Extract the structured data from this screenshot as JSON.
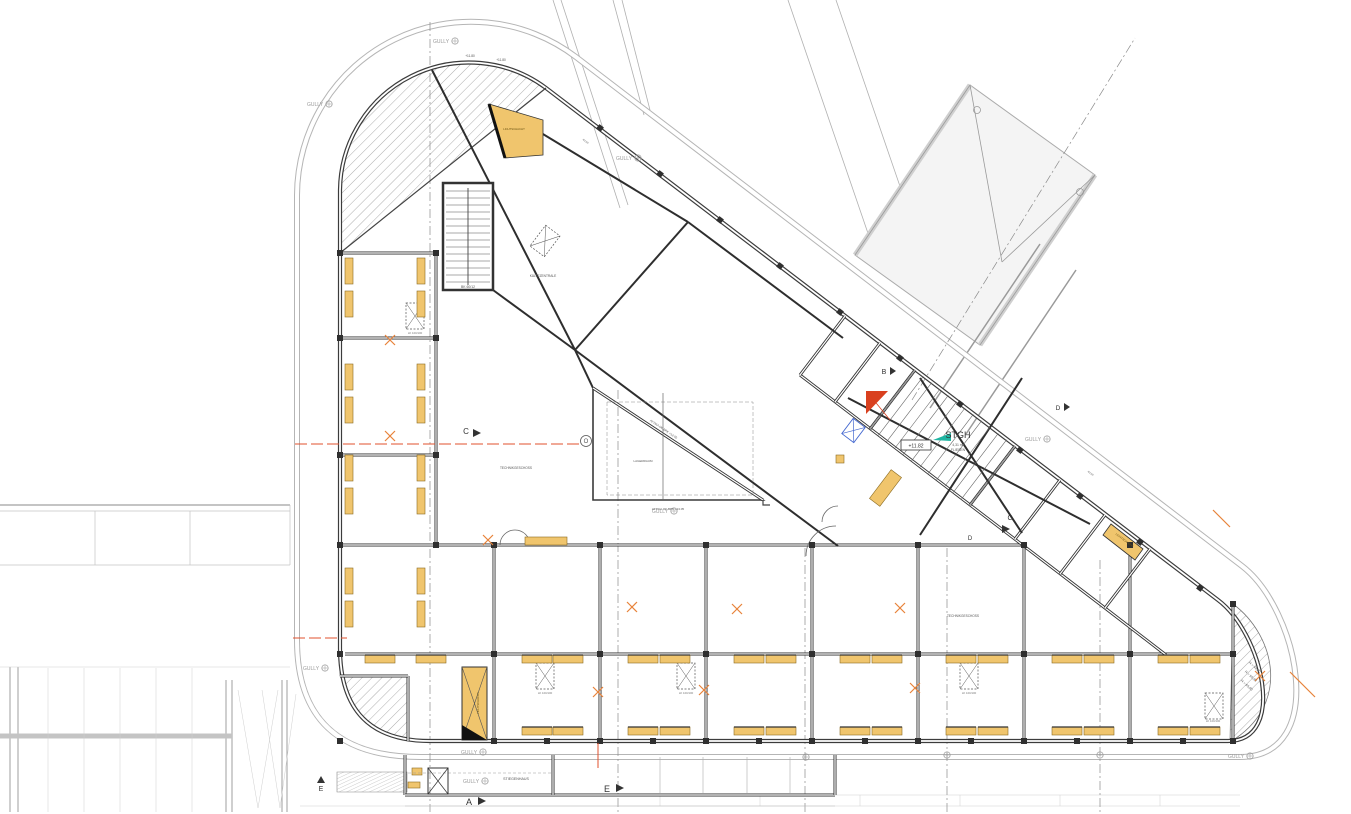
{
  "colors": {
    "paper": "#ffffff",
    "wall": "#3c3c3c",
    "dark": "#2e2e2e",
    "mid": "#8a8a8a",
    "light": "#c4c4c4",
    "ring": "#b5b5b5",
    "yellow": "#f0c56d",
    "yellow_stroke": "#8a6a20",
    "orange": "#e8833a",
    "red": "#d9401f",
    "redline": "#e0512e",
    "teal": "#1fb5a2",
    "blue": "#4468d0",
    "text": "#555555",
    "gully": "#9a9a9a"
  },
  "plan": {
    "paths": {
      "outer": "M 420,757 Q 297,757 297,640 L 297,195 A 174,174 0 0 1 576,57 L 1242,566 C 1298,609 1330,757 1240,757 Z",
      "facade": "M 430,741 Q 340,741 340,648 L 340,190 A 129,129 0 0 1 546,88 L 1218,600 C 1262,633 1288,741 1228,741 Z",
      "hatch_tl": "M 340,253 L 340,190 A 129,129 0 0 1 546,88 Z",
      "hatch_bl": "M 340,676 L 408,676 L 408,741 L 428,741 Q 342,740 340,650 Z",
      "hatch_br": "M 1233,604 C 1275,635 1292,705 1230,742 Z",
      "hatch_stairs": "M 337,772 L 407,772 L 407,792 L 337,792 Z"
    },
    "walls": [
      [
        340,
        545,
        1022,
        545
      ],
      [
        345,
        654,
        1233,
        654
      ],
      [
        494,
        545,
        494,
        741
      ],
      [
        600,
        545,
        600,
        741
      ],
      [
        706,
        545,
        706,
        741
      ],
      [
        812,
        545,
        812,
        741
      ],
      [
        918,
        545,
        918,
        741
      ],
      [
        1024,
        545,
        1024,
        741
      ],
      [
        1130,
        545,
        1130,
        741
      ],
      [
        1233,
        604,
        1233,
        741
      ],
      [
        436,
        253,
        436,
        545
      ],
      [
        340,
        253,
        436,
        253
      ],
      [
        340,
        338,
        436,
        338
      ],
      [
        340,
        455,
        436,
        455
      ],
      [
        800,
        375,
        1105,
        608
      ],
      [
        1105,
        608,
        1166,
        655
      ],
      [
        845,
        316,
        800,
        375
      ],
      [
        880,
        343,
        835,
        402
      ],
      [
        915,
        370,
        870,
        429
      ],
      [
        1015,
        446,
        970,
        505
      ],
      [
        1060,
        480,
        1015,
        539
      ],
      [
        1105,
        515,
        1060,
        574
      ],
      [
        1150,
        549,
        1105,
        608
      ],
      [
        405,
        755,
        405,
        795
      ],
      [
        405,
        795,
        835,
        795
      ],
      [
        835,
        755,
        835,
        795
      ],
      [
        553,
        755,
        553,
        795
      ],
      [
        408,
        676,
        408,
        741
      ],
      [
        340,
        676,
        408,
        676
      ]
    ],
    "chord": [
      340,
      253,
      546,
      88
    ],
    "beams": [
      [
        432,
        70,
        575,
        350
      ],
      [
        575,
        350,
        838,
        546
      ],
      [
        575,
        350,
        688,
        222
      ],
      [
        688,
        222,
        500,
        108
      ],
      [
        575,
        350,
        593,
        388
      ],
      [
        688,
        222,
        843,
        338
      ],
      [
        493,
        290,
        575,
        350
      ],
      [
        848,
        398,
        1090,
        524
      ],
      [
        920,
        378,
        1022,
        533
      ],
      [
        1022,
        378,
        920,
        535
      ]
    ],
    "rails": [
      [
        930,
        408,
        1040,
        244
      ],
      [
        966,
        434,
        1076,
        270
      ]
    ],
    "masts": [
      [
        553,
        0,
        620,
        208
      ],
      [
        561,
        0,
        628,
        205
      ],
      [
        613,
        0,
        644,
        115
      ],
      [
        622,
        0,
        652,
        118
      ],
      [
        788,
        0,
        872,
        245
      ],
      [
        836,
        0,
        915,
        230
      ]
    ],
    "dashdot": [
      [
        430,
        22,
        430,
        812
      ],
      [
        618,
        390,
        618,
        812
      ],
      [
        805,
        548,
        805,
        812
      ],
      [
        947,
        548,
        947,
        812
      ],
      [
        1100,
        560,
        1100,
        812
      ],
      [
        912,
        400,
        1135,
        38
      ]
    ],
    "bridge": {
      "body": "855,255 970,85 1095,175 980,345",
      "edges": [
        [
          855,
          255,
          970,
          85
        ],
        [
          980,
          345,
          1095,
          175
        ]
      ],
      "braces": [
        [
          970,
          85,
          1002,
          262
        ],
        [
          1002,
          262,
          1095,
          175
        ]
      ],
      "bolts": [
        [
          977,
          110
        ],
        [
          1080,
          192
        ]
      ]
    },
    "site": {
      "bandA": [
        [
          0,
          505,
          290,
          505,
          2
        ],
        [
          0,
          511,
          290,
          511,
          0.8
        ],
        [
          0,
          565,
          290,
          565,
          0.8
        ],
        [
          95,
          511,
          95,
          565,
          0.7
        ],
        [
          190,
          511,
          190,
          565,
          0.7
        ],
        [
          290,
          505,
          290,
          565,
          0.7
        ]
      ],
      "bandB_posts": [
        [
          10,
          667,
          10,
          812
        ],
        [
          18,
          667,
          18,
          812
        ],
        [
          226,
          680,
          226,
          812
        ],
        [
          232,
          680,
          232,
          812
        ],
        [
          282,
          680,
          282,
          812
        ],
        [
          287,
          680,
          287,
          812
        ]
      ],
      "bandB_bar": [
        0,
        736,
        232,
        736
      ],
      "bandB_verts": [
        [
          48,
          668,
          48,
          812
        ],
        [
          84,
          668,
          84,
          812
        ],
        [
          120,
          668,
          120,
          812
        ],
        [
          156,
          668,
          156,
          812
        ],
        [
          192,
          668,
          192,
          812
        ],
        [
          0,
          667,
          290,
          667
        ]
      ],
      "bandB_tri": [
        "238,690 258,808 278,690",
        "262,690 280,808 296,694"
      ],
      "bottom": [
        [
          300,
          806,
          1240,
          806
        ],
        [
          612,
          795,
          1240,
          795
        ]
      ],
      "ticks": [
        [
          660,
          795,
          660,
          806
        ],
        [
          760,
          795,
          760,
          806
        ],
        [
          860,
          795,
          860,
          806
        ],
        [
          960,
          795,
          960,
          806
        ],
        [
          1060,
          795,
          1060,
          806
        ],
        [
          1160,
          795,
          1160,
          806
        ]
      ]
    },
    "protrusion": {
      "verts": [
        660,
        703,
        747,
        790
      ],
      "dash": [
        408,
        773,
        553,
        773
      ],
      "xbox": [
        428,
        768,
        20,
        26
      ],
      "dim": [
        405,
        806,
        835,
        806
      ]
    },
    "stair1": {
      "x": 443,
      "y": 183,
      "w": 50,
      "h": 107
    },
    "stgh_stair": {
      "tx": 915,
      "ty": 370,
      "dx": 100,
      "dy": 76,
      "bx": 870,
      "by": 429,
      "n": 12
    },
    "atrium": {
      "v": "593,388 593,500 763,500",
      "hyp": [
        593,
        388,
        763,
        500
      ],
      "dash": [
        607,
        402,
        146,
        93
      ],
      "vline": [
        663,
        393,
        663,
        500
      ],
      "notch": "763,500 763,505 770,505"
    },
    "vents": [
      [
        406,
        303,
        0
      ],
      [
        536,
        663,
        0
      ],
      [
        677,
        663,
        0
      ],
      [
        960,
        663,
        0
      ],
      [
        1205,
        693,
        0
      ],
      [
        536,
        228,
        37
      ]
    ],
    "yellow": {
      "pairs_x": [
        345,
        417
      ],
      "pairs_y": [
        258,
        291,
        364,
        397,
        455,
        488,
        568,
        601
      ],
      "pair_w": 8,
      "pair_h": 26,
      "row1_y": 655,
      "row2_y": 727,
      "trap_w": 30,
      "trap_h": 8,
      "row1_x": [
        365,
        416,
        522,
        553,
        628,
        660,
        734,
        766,
        840,
        872,
        946,
        978,
        1052,
        1084,
        1158,
        1190
      ],
      "row2_x": [
        522,
        553,
        628,
        660,
        734,
        766,
        840,
        872,
        946,
        978,
        1052,
        1084,
        1158,
        1190
      ],
      "tall": [
        462,
        667,
        25,
        73
      ],
      "top_poly": "489,104 543,120 543,155 505,158",
      "p1": "1111,524 1143,549 1135,560 1103,535",
      "p2": [
        879,
        470,
        13,
        36,
        37
      ],
      "bar": [
        525,
        537,
        42,
        8
      ],
      "tiny": [
        [
          412,
          768,
          10,
          7
        ],
        [
          408,
          782,
          12,
          6
        ],
        [
          836,
          455,
          8,
          8
        ]
      ]
    },
    "nodes": [
      [
        494,
        545
      ],
      [
        600,
        545
      ],
      [
        706,
        545
      ],
      [
        812,
        545
      ],
      [
        918,
        545
      ],
      [
        1024,
        545
      ],
      [
        1130,
        545
      ],
      [
        494,
        654
      ],
      [
        600,
        654
      ],
      [
        706,
        654
      ],
      [
        812,
        654
      ],
      [
        918,
        654
      ],
      [
        1024,
        654
      ],
      [
        1130,
        654
      ],
      [
        494,
        741
      ],
      [
        600,
        741
      ],
      [
        706,
        741
      ],
      [
        812,
        741
      ],
      [
        918,
        741
      ],
      [
        1024,
        741
      ],
      [
        1130,
        741
      ],
      [
        340,
        253
      ],
      [
        340,
        338
      ],
      [
        340,
        455
      ],
      [
        436,
        253
      ],
      [
        436,
        338
      ],
      [
        436,
        455
      ],
      [
        1233,
        604
      ],
      [
        1233,
        654
      ],
      [
        1233,
        741
      ],
      [
        340,
        545
      ],
      [
        340,
        654
      ],
      [
        340,
        741
      ],
      [
        436,
        545
      ],
      [
        547,
        741
      ],
      [
        653,
        741
      ],
      [
        759,
        741
      ],
      [
        865,
        741
      ],
      [
        971,
        741
      ],
      [
        1077,
        741
      ],
      [
        1183,
        741
      ]
    ],
    "facade_cols": [
      [
        600,
        128
      ],
      [
        660,
        174
      ],
      [
        720,
        220
      ],
      [
        780,
        266
      ],
      [
        840,
        312
      ],
      [
        900,
        358
      ],
      [
        960,
        404
      ],
      [
        1020,
        450
      ],
      [
        1080,
        496
      ],
      [
        1140,
        542
      ],
      [
        1200,
        588
      ]
    ],
    "orange_x": [
      [
        390,
        340
      ],
      [
        390,
        436
      ],
      [
        488,
        540
      ],
      [
        632,
        607
      ],
      [
        737,
        609
      ],
      [
        900,
        608
      ],
      [
        598,
        692
      ],
      [
        704,
        690
      ],
      [
        915,
        688
      ],
      [
        1260,
        676
      ]
    ],
    "orange_ticks": [
      [
        1290,
        672,
        1315,
        697
      ],
      [
        1213,
        510,
        1230,
        527
      ]
    ],
    "red": {
      "tri": "866,391 888,391 866,414",
      "fan": [
        868,
        393,
        890,
        420
      ],
      "lines": [
        [
          295,
          444,
          590,
          444,
          1
        ],
        [
          293,
          638,
          347,
          638,
          1
        ],
        [
          598,
          743,
          598,
          768,
          0
        ]
      ]
    },
    "teal": "933,440 951,433 951,441",
    "blue": [
      846,
      421,
      15,
      19,
      37
    ],
    "doors": [
      "M 500,545 A 15,15 0 0 1 515,530",
      "M 530,545 A 15,15 0 0 0 515,530",
      "M 806,556 A 30,30 0 0 1 836,526",
      "M 822,522 A 16,16 0 0 1 838,506"
    ],
    "gully": {
      "label": "GULLY",
      "at": [
        [
          433,
          41
        ],
        [
          307,
          104
        ],
        [
          616,
          158
        ],
        [
          1025,
          439
        ],
        [
          652,
          511
        ],
        [
          303,
          668
        ],
        [
          461,
          752
        ],
        [
          463,
          781
        ],
        [
          1228,
          756
        ]
      ],
      "extra_sym": [
        [
          806,
          757
        ],
        [
          947,
          755
        ],
        [
          1100,
          755
        ]
      ]
    },
    "elev_box": {
      "rect": [
        901,
        440,
        30,
        10
      ],
      "text": "+11.82"
    },
    "labels": [
      [
        "STGH",
        958,
        438,
        9,
        0,
        "#333333"
      ],
      [
        "4,31 m²",
        958,
        446,
        3.4,
        0,
        "#555555"
      ],
      [
        "FLIESEN",
        958,
        451,
        3.4,
        0,
        "#555555"
      ],
      [
        "+11.80",
        470,
        57,
        3.2,
        0,
        "#555555"
      ],
      [
        "+11.80",
        501,
        61,
        3.2,
        0,
        "#555555"
      ],
      [
        "TECHNIKGESCHOSS",
        516,
        469,
        3.2,
        0,
        "#555555"
      ],
      [
        "TECHNIKGESCHOSS",
        963,
        617,
        3.2,
        0,
        "#555555"
      ],
      [
        "KÄLTEZENTRALE",
        543,
        277,
        3.2,
        0,
        "#555555"
      ],
      [
        "LAGERRAUM",
        643,
        462,
        3,
        0,
        "#555555"
      ],
      [
        "STIEGENHAUS",
        516,
        780,
        3.6,
        0,
        "#555555"
      ],
      [
        "LICHTSCHACHT",
        514,
        130,
        2.8,
        0,
        "#6b5312"
      ],
      [
        "LICHTSCHACHT",
        479,
        703,
        2.8,
        -90,
        "#6b5312"
      ],
      [
        "LICHTSCHACHT",
        1124,
        541,
        2.8,
        37,
        "#6b5312"
      ],
      [
        "LK 100/100",
        415,
        334,
        2.8,
        0,
        "#777777"
      ],
      [
        "LK 100/100",
        545,
        694,
        2.8,
        0,
        "#777777"
      ],
      [
        "LK 100/100",
        686,
        694,
        2.8,
        0,
        "#777777"
      ],
      [
        "LK 100/100",
        969,
        694,
        2.8,
        0,
        "#777777"
      ],
      [
        "LK 100/100",
        1213,
        722,
        2.8,
        0,
        "#777777"
      ],
      [
        "BK 60/12",
        468,
        288,
        3.4,
        0,
        "#555555"
      ],
      [
        "R = 48,50",
        1254,
        668,
        3.4,
        42,
        "#555555"
      ],
      [
        "R = 50,40",
        1250,
        677,
        3.4,
        42,
        "#555555"
      ],
      [
        "R = 65,60",
        1246,
        686,
        3.4,
        42,
        "#555555"
      ],
      [
        "ATTIKA OK BPK +13.05",
        663,
        430,
        3,
        33.5,
        "#555555"
      ],
      [
        "ATTIKA OK BPK +13.05",
        668,
        510,
        3,
        0,
        "#555555"
      ],
      [
        "Φ150",
        585,
        142,
        2.8,
        37,
        "#777777"
      ],
      [
        "Φ150",
        1090,
        474,
        2.8,
        37,
        "#777777"
      ]
    ],
    "sections": [
      [
        "A",
        469,
        805,
        9,
        "478,797 486,801 478,805"
      ],
      [
        "E",
        607,
        792,
        9,
        "616,784 624,788 616,792"
      ],
      [
        "E",
        321,
        791,
        7,
        "317,783 325,783 321,776"
      ],
      [
        "B",
        884,
        374,
        7,
        "890,367 896,371 890,375"
      ],
      [
        "C",
        466,
        434,
        8,
        "473,429 481,433 473,437"
      ],
      [
        "C",
        1010,
        520,
        7,
        "1002,525 1010,529 1002,533"
      ],
      [
        "D",
        1058,
        410,
        6.5,
        "1064,403 1070,407 1064,411"
      ],
      [
        "D",
        970,
        540,
        6,
        ""
      ]
    ],
    "axis_bubble": {
      "letter": "O",
      "x": 586,
      "y": 441,
      "r": 5.5
    }
  }
}
